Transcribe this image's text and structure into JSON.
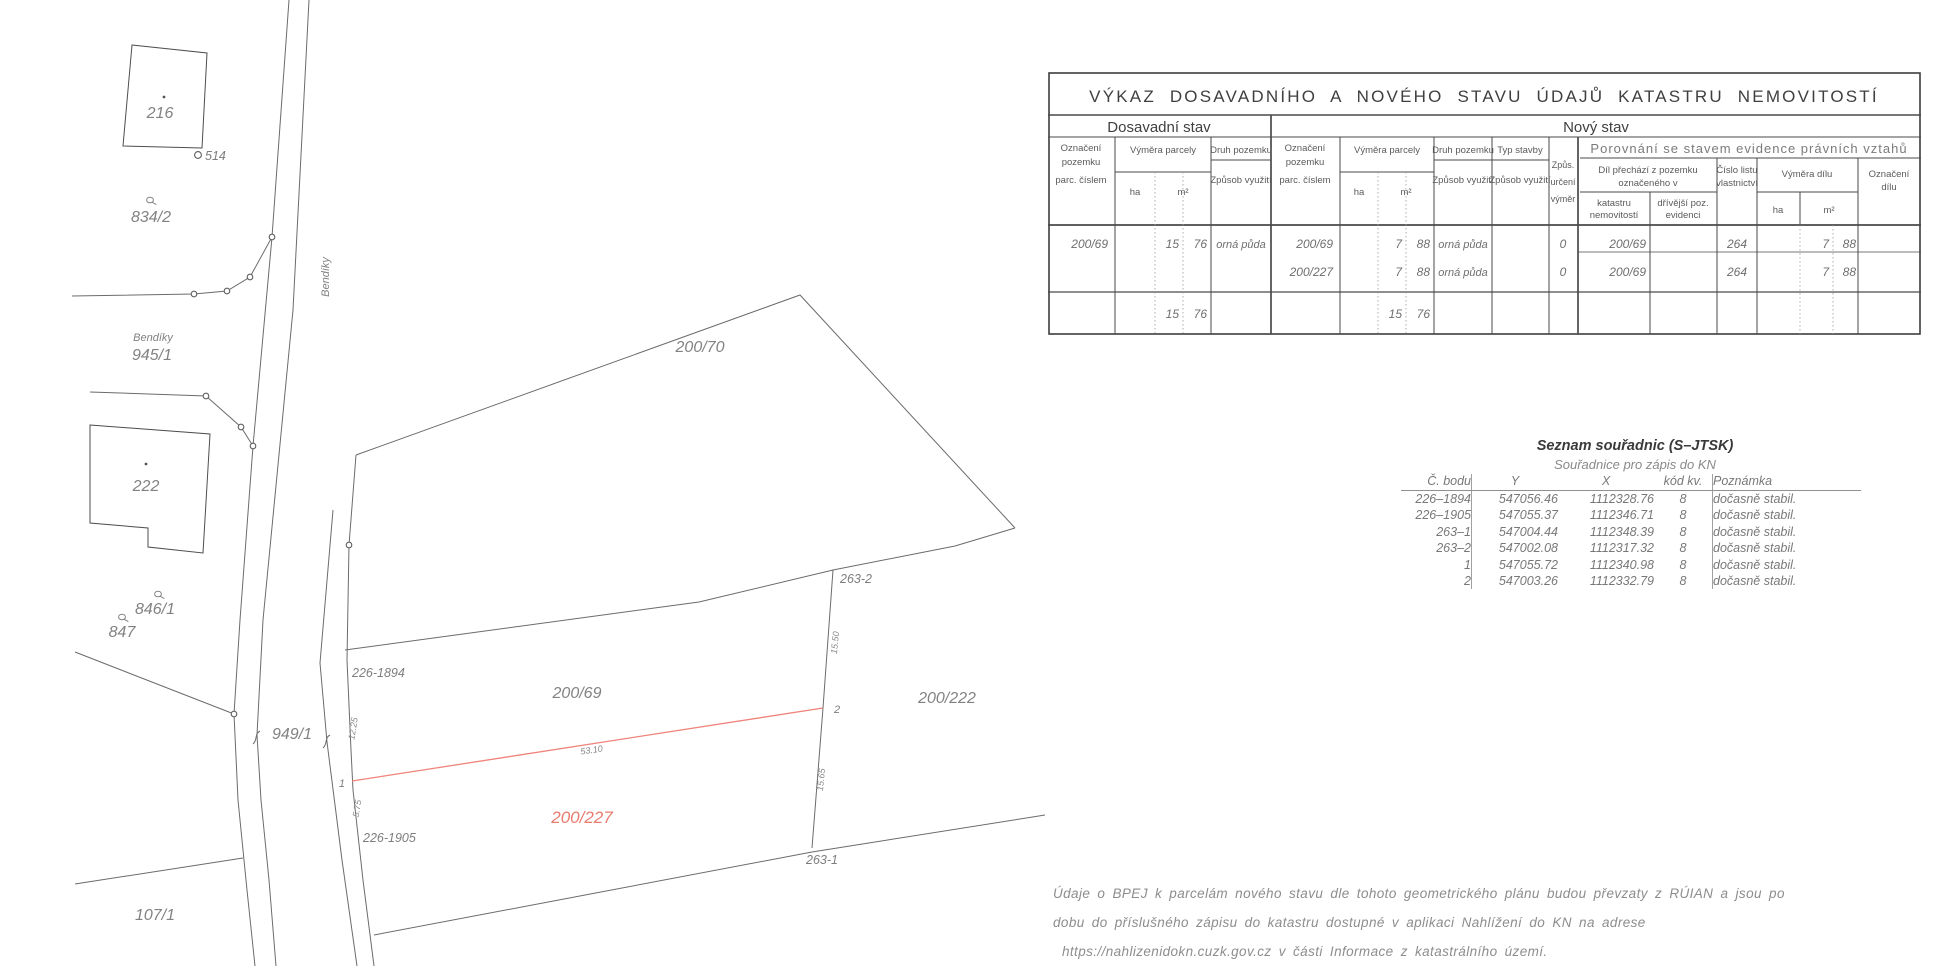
{
  "map": {
    "colors": {
      "line": "#6b6b6b",
      "building": "#4d4d4d",
      "red_line": "#f0837a",
      "label": "#828282"
    },
    "labels": {
      "b216": "216",
      "p514": "514",
      "p834_2": "834/2",
      "road_name": "Bendíky",
      "area_bendiky": "Bendíky",
      "p945_1": "945/1",
      "b222": "222",
      "p846_1": "846/1",
      "p847": "847",
      "p949_1": "949/1",
      "p107_1": "107/1",
      "p200_70": "200/70",
      "p200_69": "200/69",
      "p200_227": "200/227",
      "p200_222": "200/222",
      "pt226_1894": "226-1894",
      "pt226_1905": "226-1905",
      "pt263_1": "263-1",
      "pt263_2": "263-2",
      "pt1": "1",
      "pt2": "2",
      "m12_25": "12.25",
      "m5_75": "5.75",
      "m53_10": "53.10",
      "m15_50": "15.50",
      "m15_65": "15.65"
    }
  },
  "vykaz": {
    "title": "VÝKAZ DOSAVADNÍHO A NOVÉHO STAVU ÚDAJŮ KATASTRU NEMOVITOSTÍ",
    "old_state": "Dosavadní stav",
    "new_state": "Nový stav",
    "comparison": "Porovnání se stavem evidence právních vztahů",
    "headers": {
      "ozn_l1": "Označení",
      "ozn_l2": "pozemku",
      "ozn_l3": "parc. číslem",
      "vymera": "Výměra parcely",
      "ha": "ha",
      "m2": "m²",
      "druh": "Druh pozemku",
      "zpusob": "Způsob využití",
      "typ": "Typ stavby",
      "zpus_l1": "Způs.",
      "zpus_l2": "určení",
      "zpus_l3": "výměr",
      "dil_l1": "Díl přechází z pozemku",
      "dil_l2": "označeného v",
      "kat_l1": "katastru",
      "kat_l2": "nemovitostí",
      "drive_l1": "dřívější poz.",
      "drive_l2": "evidenci",
      "clv_l1": "Číslo listu",
      "clv_l2": "vlastnictví",
      "vymdil": "Výměra dílu",
      "ozndil_l1": "Označení",
      "ozndil_l2": "dílu"
    },
    "rows": [
      {
        "old_parcel": "200/69",
        "old_m2a": "15",
        "old_m2b": "76",
        "old_druh": "orná půda",
        "new_parcel": "200/69",
        "new_m2a": "7",
        "new_m2b": "88",
        "new_druh": "orná půda",
        "zpus": "0",
        "kat": "200/69",
        "clv": "264",
        "dil_m2a": "7",
        "dil_m2b": "88"
      },
      {
        "new_parcel": "200/227",
        "new_m2a": "7",
        "new_m2b": "88",
        "new_druh": "orná půda",
        "zpus": "0",
        "kat": "200/69",
        "clv": "264",
        "dil_m2a": "7",
        "dil_m2b": "88"
      }
    ],
    "sum": {
      "old_m2a": "15",
      "old_m2b": "76",
      "new_m2a": "15",
      "new_m2b": "76"
    }
  },
  "coords": {
    "title": "Seznam souřadnic (S–JTSK)",
    "subtitle": "Souřadnice pro zápis do KN",
    "headers": {
      "bodu": "Č. bodu",
      "y": "Y",
      "x": "X",
      "kod": "kód kv.",
      "note": "Poznámka"
    },
    "rows": [
      {
        "id": "226–1894",
        "y": "547056.46",
        "x": "1112328.76",
        "kod": "8",
        "note": "dočasně stabil."
      },
      {
        "id": "226–1905",
        "y": "547055.37",
        "x": "1112346.71",
        "kod": "8",
        "note": "dočasně stabil."
      },
      {
        "id": "263–1",
        "y": "547004.44",
        "x": "1112348.39",
        "kod": "8",
        "note": "dočasně stabil."
      },
      {
        "id": "263–2",
        "y": "547002.08",
        "x": "1112317.32",
        "kod": "8",
        "note": "dočasně stabil."
      },
      {
        "id": "1",
        "y": "547055.72",
        "x": "1112340.98",
        "kod": "8",
        "note": "dočasně stabil."
      },
      {
        "id": "2",
        "y": "547003.26",
        "x": "1112332.79",
        "kod": "8",
        "note": "dočasně stabil."
      }
    ]
  },
  "footer": {
    "line1": "Údaje o BPEJ k parcelám nového stavu dle tohoto geometrického plánu budou převzaty z RÚIAN a jsou po",
    "line2": "dobu do příslušného zápisu do katastru dostupné v aplikaci Nahlížení do KN na adrese",
    "line3": "https://nahlizenidokn.cuzk.gov.cz v části Informace z katastrálního území."
  }
}
